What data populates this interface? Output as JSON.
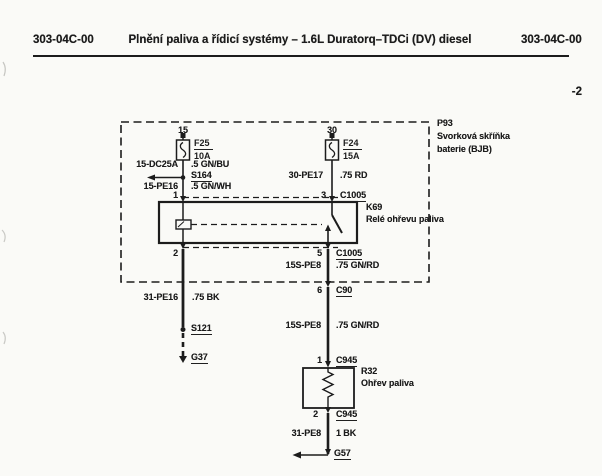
{
  "header": {
    "code_left": "303-04C-00",
    "title": "Plnění paliva a řídicí systémy – 1.6L Duratorq–TDCi (DV) diesel",
    "code_right": "303-04C-00",
    "sheet_number": "-2"
  },
  "colors": {
    "ink": "#1f1f1f",
    "paper": "#fafaf7"
  },
  "diagram": {
    "bjb": {
      "id": "P93",
      "name_line1": "Svorková skříňka",
      "name_line2": "baterie (BJB)"
    },
    "fuses": {
      "f25": {
        "terminal": "15",
        "id": "F25",
        "rating": "10A"
      },
      "f24": {
        "terminal": "30",
        "id": "F24",
        "rating": "15A"
      }
    },
    "relay": {
      "id": "K69",
      "name": "Relé ohřevu paliva",
      "pin_top_left": "1",
      "pin_bottom_left": "2",
      "pin_top_right": "3",
      "pin_bottom_right": "5",
      "connector_top": "C1005",
      "connector_bottom": "C1005"
    },
    "wires": {
      "coil_feed_upper": {
        "circuit": "15-DC25A",
        "spec": ".5 GN/BU"
      },
      "coil_feed_lower": {
        "circuit": "15-PE16",
        "spec": ".5 GN/WH"
      },
      "battery_feed": {
        "circuit": "30-PE17",
        "spec": ".75 RD"
      },
      "heater_feed_upper": {
        "circuit": "15S-PE8",
        "spec": ".75 GN/RD"
      },
      "coil_ground": {
        "circuit": "31-PE16",
        "spec": ".75 BK"
      },
      "heater_feed_lower": {
        "circuit": "15S-PE8",
        "spec": ".75 GN/RD"
      },
      "heater_ground": {
        "circuit": "31-PE8",
        "spec": "1 BK"
      }
    },
    "splices": {
      "s164": "S164",
      "s121": "S121"
    },
    "grounds": {
      "g37": "G37",
      "g57": "G57"
    },
    "connectors": {
      "c90": {
        "pin": "6",
        "id": "C90"
      },
      "c945_top": {
        "pin": "1",
        "id": "C945"
      },
      "c945_bottom": {
        "pin": "2",
        "id": "C945"
      }
    },
    "heater": {
      "id": "R32",
      "name": "Ohřev paliva"
    }
  }
}
